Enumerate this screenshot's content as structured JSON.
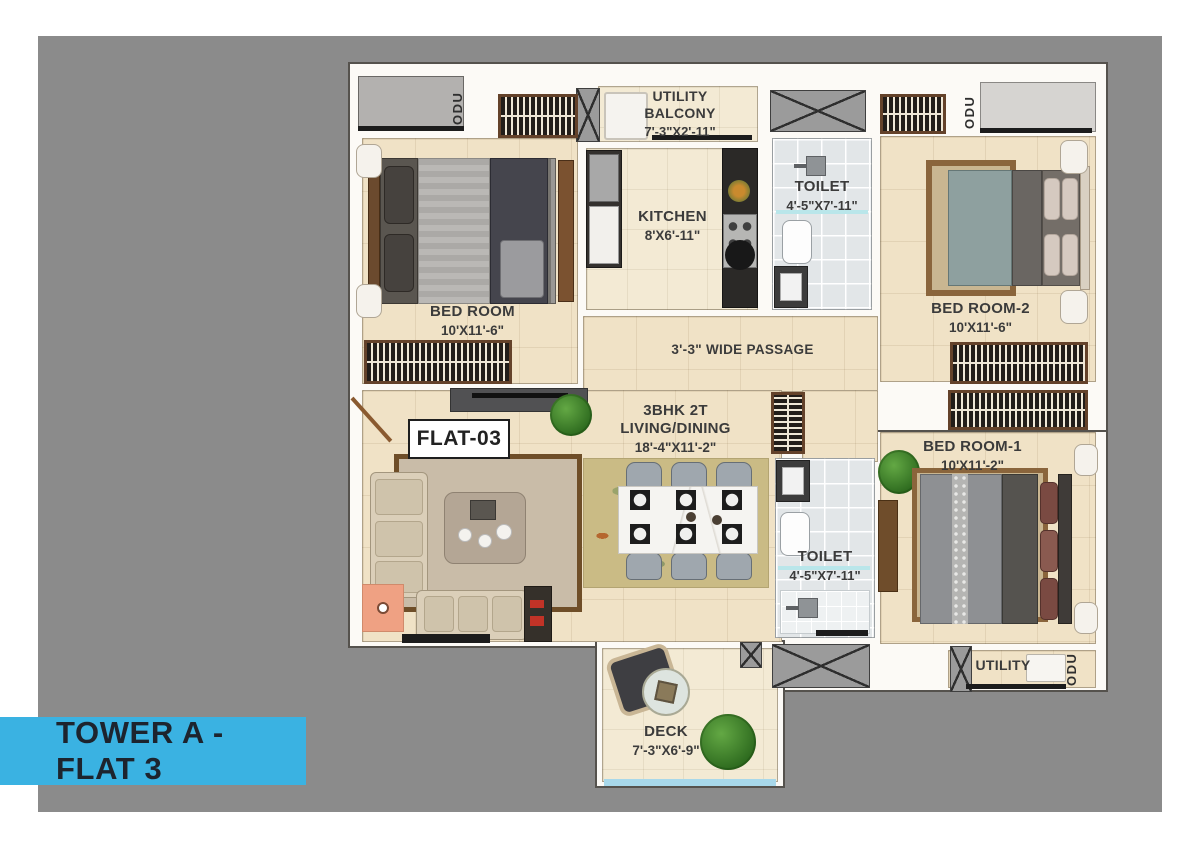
{
  "banner": {
    "text": "TOWER A - FLAT 3"
  },
  "flat_badge": {
    "text": "FLAT-03"
  },
  "labels": {
    "odu": "ODU"
  },
  "rooms": {
    "utility_balcony": {
      "name": "UTILITY BALCONY",
      "dims": "7'-3\"X2'-11\""
    },
    "kitchen": {
      "name": "KITCHEN",
      "dims": "8'X6'-11\""
    },
    "toilet_top": {
      "name": "TOILET",
      "dims": "4'-5\"X7'-11\""
    },
    "bedroom": {
      "name": "BED ROOM",
      "dims": "10'X11'-6\""
    },
    "bedroom2": {
      "name": "BED ROOM-2",
      "dims": "10'X11'-6\""
    },
    "bedroom1": {
      "name": "BED ROOM-1",
      "dims": "10'X11'-2\""
    },
    "passage": {
      "name": "3'-3\" WIDE PASSAGE"
    },
    "living_dining": {
      "line1": "3BHK 2T",
      "line2": "LIVING/DINING",
      "dims": "18'-4\"X11'-2\""
    },
    "toilet_bottom": {
      "name": "TOILET",
      "dims": "4'-5\"X7'-11\""
    },
    "utility": {
      "name": "UTILITY"
    },
    "deck": {
      "name": "DECK",
      "dims": "7'-3\"X6'-9\""
    }
  },
  "colors": {
    "banner_blue": "#3ab2e2",
    "backdrop_gray": "#8b8b8b",
    "floor_beige": "#f0e2c6",
    "toilet_tile": "#e2e6e8",
    "wall_white": "#fcfaf6"
  }
}
